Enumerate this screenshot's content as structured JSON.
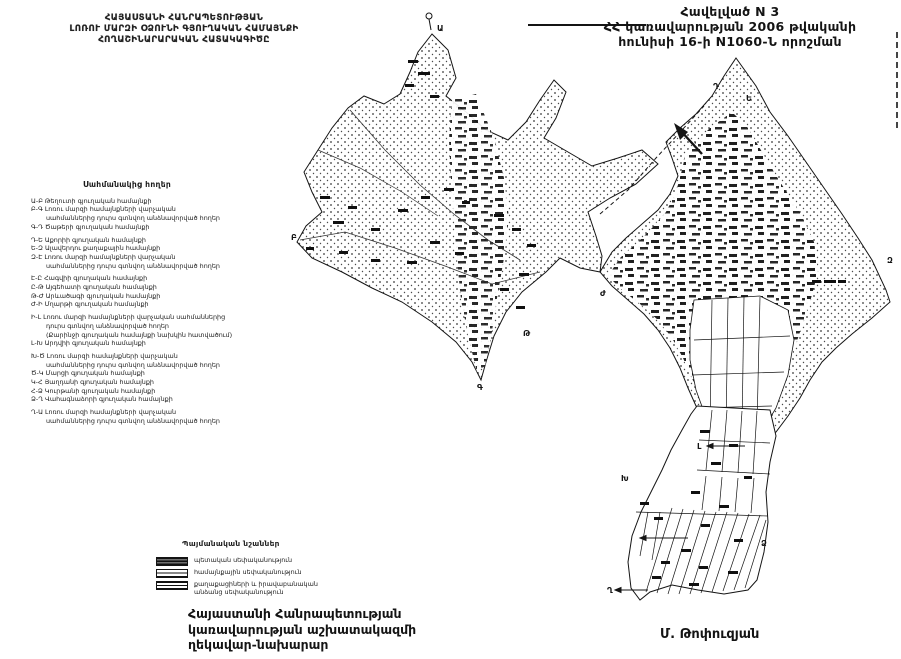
{
  "appendix": {
    "line1": "Հավելված N 3",
    "line2": "ՀՀ կառավարության 2006 թվականի",
    "line3": "հունիսի 16-ի N1060-Ն որոշման"
  },
  "title": {
    "line1": "ՀԱՅԱՍՏԱՆԻ ՀԱՆՐԱՊԵՏՈՒԹՅԱՆ",
    "line2": "ԼՈՌՈՒ ՄԱՐԶԻ ՕՁՈՒՆԻ ԳՅՈՒՂԱԿԱՆ ՀԱՄԱՅՆՔԻ",
    "line3": "ՀՈՂԱՇԻՆԱՐԱՐԱԿԱՆ ՀԱՏԱԿԱԳԻԾԸ"
  },
  "border_legend": {
    "heading": "Սահմանակից հողեր",
    "items": [
      {
        "text": "Ա-Բ  Թեղուտի գյուղական համայնքի",
        "indent": false,
        "gap": false
      },
      {
        "text": "Բ-Գ  Լոռու մարզի համայնքների վարչական",
        "indent": false,
        "gap": false
      },
      {
        "text": "սահմաններից դուրս գտնվող անձնավորված հողեր",
        "indent": true,
        "gap": false
      },
      {
        "text": "Գ-Դ  Ծաթերի գյուղական համայնքի",
        "indent": false,
        "gap": false
      },
      {
        "text": "Դ-Ե  Աքորիի գյուղական համայնքի",
        "indent": false,
        "gap": true
      },
      {
        "text": "Ե-Զ  Ալավերդու քաղաքային համայնքի",
        "indent": false,
        "gap": false
      },
      {
        "text": "Զ-Է  Լոռու մարզի համայնքների վարչական",
        "indent": false,
        "gap": false
      },
      {
        "text": "սահմաններից դուրս գտնվող անձնավորված հողեր",
        "indent": true,
        "gap": false
      },
      {
        "text": "Է-Ը  Հագվիի գյուղական համայնքի",
        "indent": false,
        "gap": true
      },
      {
        "text": "Ը-Թ  Այգեհատի գյուղական համայնքի",
        "indent": false,
        "gap": false
      },
      {
        "text": "Թ-Ժ  Արևածագի գյուղական համայնքի",
        "indent": false,
        "gap": false
      },
      {
        "text": "Ժ-Ի  Մղարթի գյուղական համայնքի",
        "indent": false,
        "gap": false
      },
      {
        "text": "Ի-Լ  Լոռու մարզի համայնքների վարչական սահմաններից",
        "indent": false,
        "gap": true
      },
      {
        "text": "դուրս գտնվող անձնավորված հողեր",
        "indent": true,
        "gap": false
      },
      {
        "text": "(Քարինջի գյուղական համայնքի նախկին հատվածում)",
        "indent": true,
        "gap": false
      },
      {
        "text": "Լ-Խ  Արդվիի գյուղական համայնքի",
        "indent": false,
        "gap": false
      },
      {
        "text": "Խ-Ծ  Լոռու մարզի համայնքների վարչական",
        "indent": false,
        "gap": true
      },
      {
        "text": "սահմաններից դուրս գտնվող անձնավորված հողեր",
        "indent": true,
        "gap": false
      },
      {
        "text": "Ծ-Կ  Մարցի գյուղական համայնքի",
        "indent": false,
        "gap": false
      },
      {
        "text": "Կ-Հ  Յաղդանի գյուղական համայնքի",
        "indent": false,
        "gap": false
      },
      {
        "text": "Հ-Ձ  Կուրթանի գյուղական համայնքի",
        "indent": false,
        "gap": false
      },
      {
        "text": "Ձ-Ղ  Վահագնաձորի գյուղական համայնքի",
        "indent": false,
        "gap": false
      },
      {
        "text": "Ղ-Ա  Լոռու մարզի համայնքների վարչական",
        "indent": false,
        "gap": true
      },
      {
        "text": "սահմաններից դուրս գտնվող անձնավորված հողեր",
        "indent": true,
        "gap": false
      }
    ]
  },
  "signs_legend": {
    "heading": "Պայմանական նշաններ",
    "items": [
      {
        "label": "պետական սեփականություն",
        "swatch": "state"
      },
      {
        "label": "համայնքային սեփականություն",
        "swatch": "community"
      },
      {
        "label": "քաղաքացիների և իրավաբանական անձանց սեփականություն",
        "swatch": "private"
      }
    ]
  },
  "signature": {
    "line1": "Հայաստանի Հանրապետության",
    "line2": "կառավարության աշխատակազմի",
    "line3": "ղեկավար-նախարար",
    "name": "Մ. Թոփուզյան"
  },
  "map": {
    "border_points": [
      {
        "label": "Ա",
        "x": 437,
        "y": 31
      },
      {
        "label": "Բ",
        "x": 291,
        "y": 240
      },
      {
        "label": "Գ",
        "x": 477,
        "y": 390
      },
      {
        "label": "Դ",
        "x": 713,
        "y": 89
      },
      {
        "label": "Ե",
        "x": 746,
        "y": 101
      },
      {
        "label": "Զ",
        "x": 887,
        "y": 263
      },
      {
        "label": "Թ",
        "x": 523,
        "y": 336
      },
      {
        "label": "Ժ",
        "x": 600,
        "y": 296
      },
      {
        "label": "Լ",
        "x": 697,
        "y": 449
      },
      {
        "label": "Խ",
        "x": 621,
        "y": 481
      },
      {
        "label": "Ձ",
        "x": 761,
        "y": 546
      },
      {
        "label": "Ղ",
        "x": 607,
        "y": 593
      }
    ]
  }
}
